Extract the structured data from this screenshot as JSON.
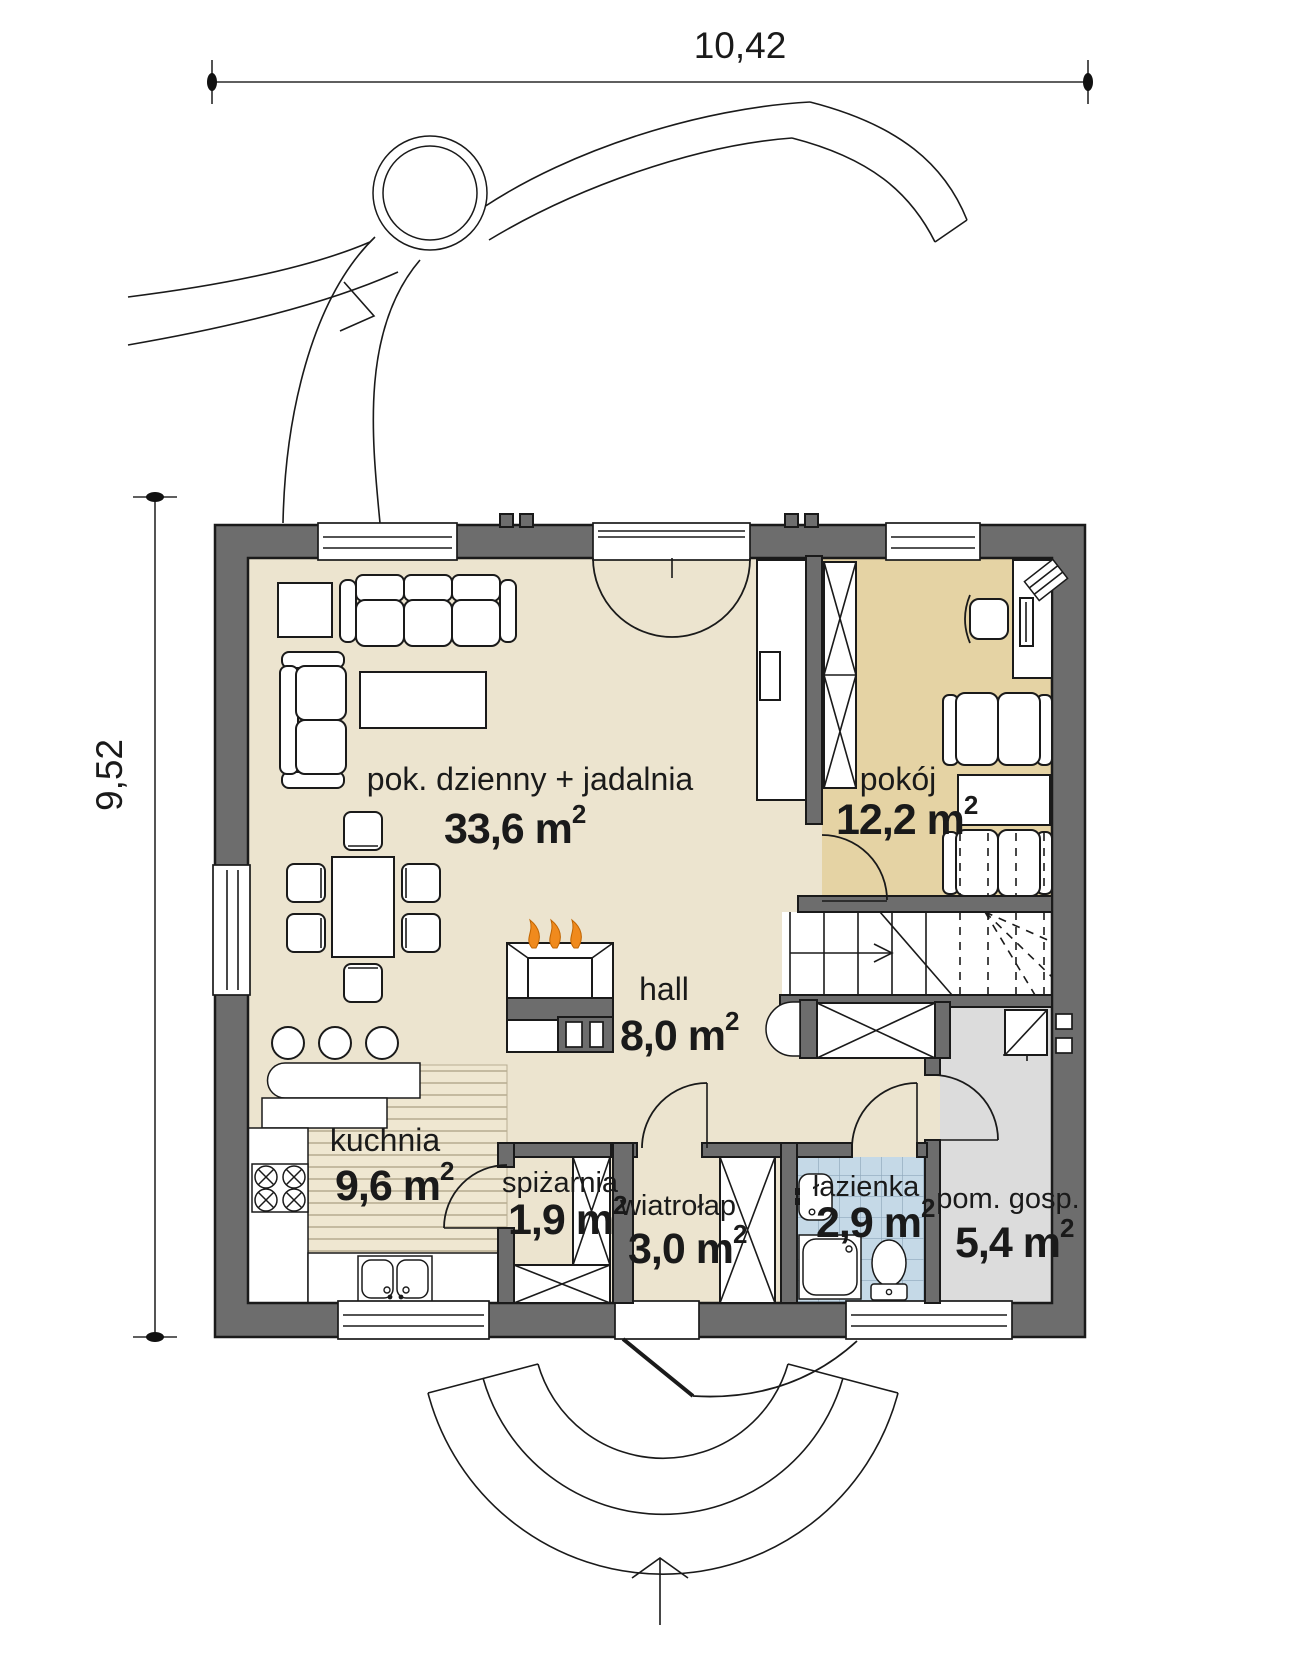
{
  "drawing_type": "house floor plan (ground floor)",
  "dimensions": {
    "width_label": "10,42",
    "height_label": "9,52"
  },
  "sup_char": "2",
  "rooms": [
    {
      "id": "living",
      "name": "pok. dzienny + jadalnia",
      "area": "33,6 m"
    },
    {
      "id": "pokoj",
      "name": "pokój",
      "area": "12,2 m"
    },
    {
      "id": "hall",
      "name": "hall",
      "area": "8,0 m"
    },
    {
      "id": "kuchnia",
      "name": "kuchnia",
      "area": "9,6 m"
    },
    {
      "id": "spizarnia",
      "name": "spiżarnia",
      "area": "1,9 m"
    },
    {
      "id": "wiatrolap",
      "name": "wiatrołap",
      "area": "3,0 m"
    },
    {
      "id": "lazienka",
      "name": "łazienka",
      "area": "2,9 m"
    },
    {
      "id": "pomgosp",
      "name": "pom. gosp.",
      "area": "5,4 m"
    }
  ],
  "colors": {
    "wall": "#6d6d6d",
    "floor_main": "#ece4cf",
    "floor_room": "#e5d3a4",
    "floor_kitchen": "#efe7d1",
    "floor_bath_tile": "#c5d9e7",
    "floor_utility": "#dcdcdc",
    "flame": "#f08a1d",
    "line": "#1a1a1a"
  }
}
